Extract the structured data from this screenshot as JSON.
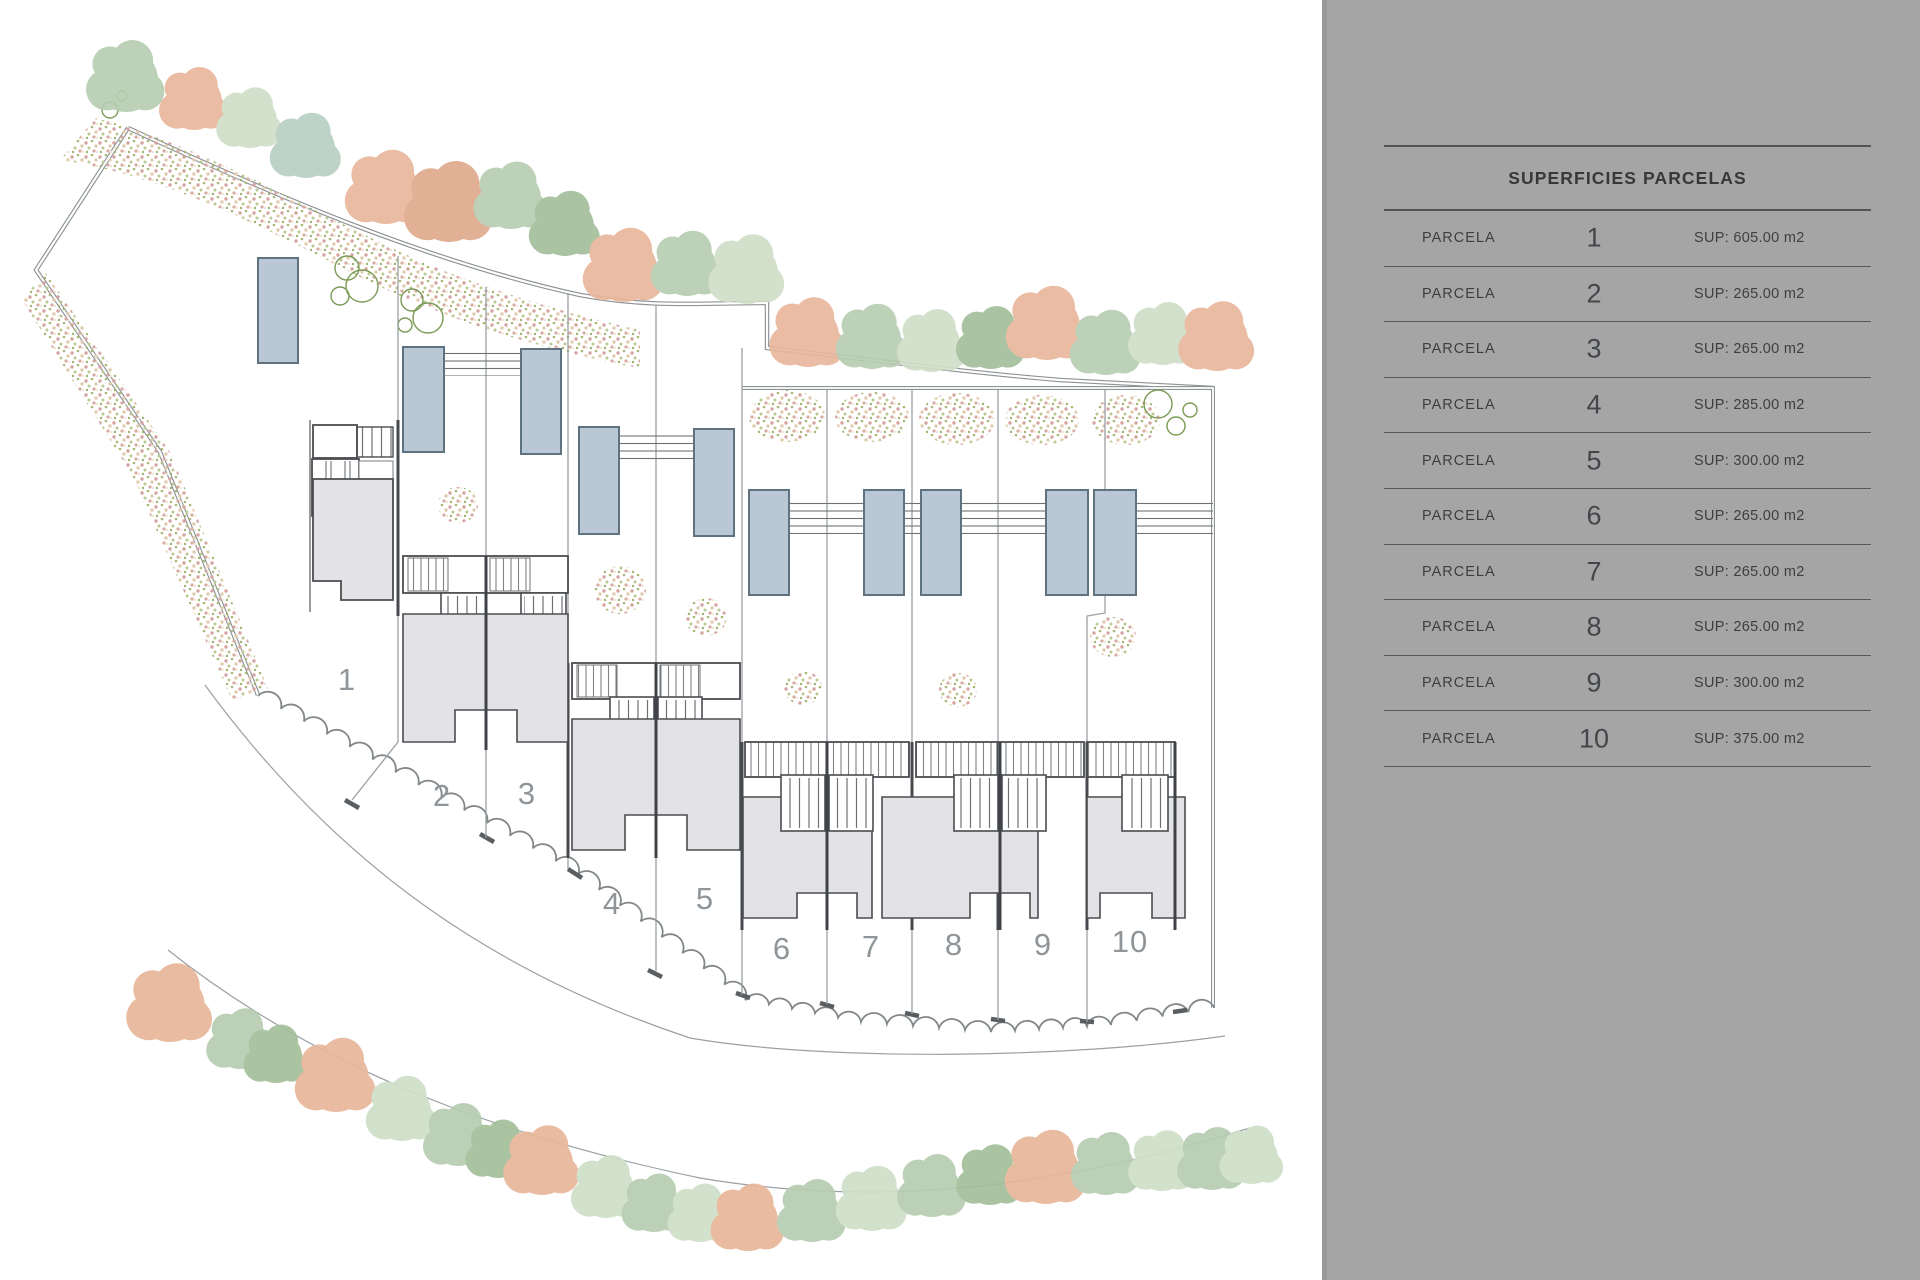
{
  "panel": {
    "title": "SUPERFICIES PARCELAS",
    "rows": [
      {
        "label": "PARCELA",
        "number": "1",
        "sup": "SUP: 605.00 m2"
      },
      {
        "label": "PARCELA",
        "number": "2",
        "sup": "SUP: 265.00 m2"
      },
      {
        "label": "PARCELA",
        "number": "3",
        "sup": "SUP: 265.00 m2"
      },
      {
        "label": "PARCELA",
        "number": "4",
        "sup": "SUP: 285.00 m2"
      },
      {
        "label": "PARCELA",
        "number": "5",
        "sup": "SUP: 300.00 m2"
      },
      {
        "label": "PARCELA",
        "number": "6",
        "sup": "SUP: 265.00 m2"
      },
      {
        "label": "PARCELA",
        "number": "7",
        "sup": "SUP: 265.00 m2"
      },
      {
        "label": "PARCELA",
        "number": "8",
        "sup": "SUP: 265.00 m2"
      },
      {
        "label": "PARCELA",
        "number": "9",
        "sup": "SUP: 300.00 m2"
      },
      {
        "label": "PARCELA",
        "number": "10",
        "sup": "SUP: 375.00 m2"
      }
    ]
  },
  "plan": {
    "parcel_labels": [
      "1",
      "2",
      "3",
      "4",
      "5",
      "6",
      "7",
      "8",
      "9",
      "10"
    ]
  },
  "colors": {
    "panel_gray": "#a5a5a5",
    "pool_fill": "#b9c8d4",
    "pool_stroke": "#5f7280",
    "terrace_gray": "#e3e3e5",
    "tree_sage": "#b7cdb1",
    "tree_pale": "#cfdfc8",
    "tree_salmon": "#e8b79b",
    "line_dark": "#45484b",
    "line_mid": "#8d9295"
  }
}
